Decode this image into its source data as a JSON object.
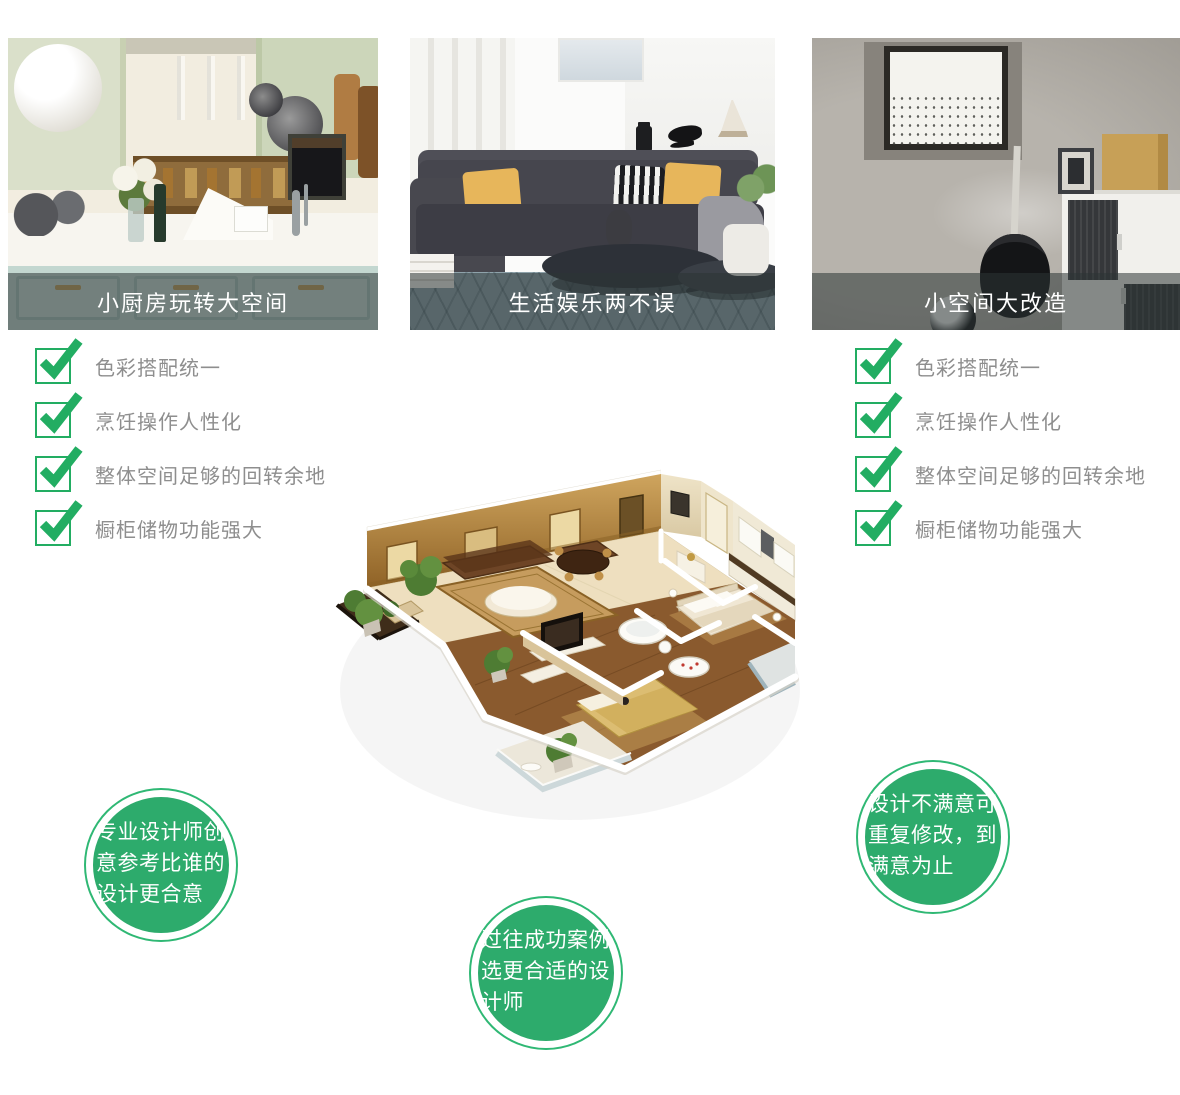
{
  "theme": {
    "accent_green": "#22ad62",
    "badge_green": "#2dab6c",
    "caption_overlay": "rgba(44,52,52,0.55)",
    "checklist_text_gray": "#8e8e8e"
  },
  "feature_cards": [
    {
      "caption": "小厨房玩转大空间",
      "image": "kitchen-showroom-photo"
    },
    {
      "caption": "生活娱乐两不误",
      "image": "living-room-sofa-photo"
    },
    {
      "caption": "小空间大改造",
      "image": "small-room-makeover-photo"
    }
  ],
  "checklist_left": {
    "items": [
      "色彩搭配统一",
      "烹饪操作人性化",
      "整体空间足够的回转余地",
      "橱柜储物功能强大"
    ]
  },
  "checklist_right": {
    "items": [
      "色彩搭配统一",
      "烹饪操作人性化",
      "整体空间足够的回转余地",
      "橱柜储物功能强大"
    ]
  },
  "badges": [
    {
      "text": "专业设计师创意参考比谁的设计更合意"
    },
    {
      "text": "过往成功案例选更合适的设计师"
    },
    {
      "text": "设计不满意可重复修改，到满意为止"
    }
  ],
  "floor_plan": {
    "icon": "3d-apartment-floorplan-illustration"
  }
}
